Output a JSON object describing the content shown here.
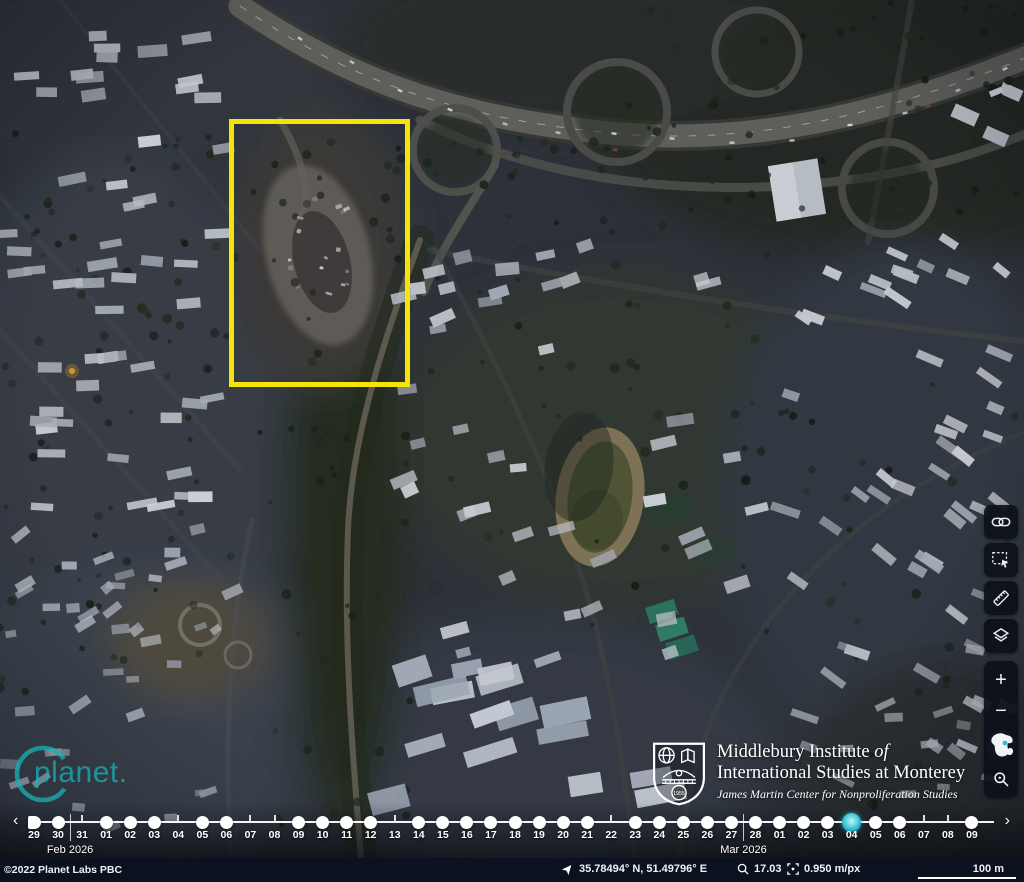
{
  "colors": {
    "annotation": "#f5e409",
    "selected_date": "#14aac2",
    "planet_teal": "#19b2b8",
    "timeline_dot": "#ffffff"
  },
  "toolbar": {
    "buttons": [
      {
        "name": "share-link",
        "icon": "link-icon"
      },
      {
        "name": "select-area",
        "icon": "selection-icon"
      },
      {
        "name": "measure",
        "icon": "ruler-icon"
      },
      {
        "name": "layers",
        "icon": "layers-icon"
      }
    ]
  },
  "zoom_controls": {
    "zoom_in": "+",
    "zoom_out": "−",
    "globe": "globe-icon",
    "search": "magnifier-icon"
  },
  "timeline": {
    "prev": "‹",
    "next": "›",
    "months": [
      {
        "label": "Feb 2026",
        "after_index": 1
      },
      {
        "label": "Mar 2026",
        "after_index": 29
      }
    ],
    "dates": [
      {
        "day": "29",
        "dot": true
      },
      {
        "day": "30",
        "dot": true
      },
      {
        "day": "31",
        "dot": false
      },
      {
        "day": "01",
        "dot": true
      },
      {
        "day": "02",
        "dot": true
      },
      {
        "day": "03",
        "dot": true
      },
      {
        "day": "04",
        "dot": false
      },
      {
        "day": "05",
        "dot": true
      },
      {
        "day": "06",
        "dot": true
      },
      {
        "day": "07",
        "dot": false
      },
      {
        "day": "08",
        "dot": false
      },
      {
        "day": "09",
        "dot": true
      },
      {
        "day": "10",
        "dot": true
      },
      {
        "day": "11",
        "dot": true
      },
      {
        "day": "12",
        "dot": true
      },
      {
        "day": "13",
        "dot": false
      },
      {
        "day": "14",
        "dot": true
      },
      {
        "day": "15",
        "dot": true
      },
      {
        "day": "16",
        "dot": true
      },
      {
        "day": "17",
        "dot": true
      },
      {
        "day": "18",
        "dot": true
      },
      {
        "day": "19",
        "dot": true
      },
      {
        "day": "20",
        "dot": true
      },
      {
        "day": "21",
        "dot": true
      },
      {
        "day": "22",
        "dot": false
      },
      {
        "day": "23",
        "dot": true
      },
      {
        "day": "24",
        "dot": true
      },
      {
        "day": "25",
        "dot": true
      },
      {
        "day": "26",
        "dot": true
      },
      {
        "day": "27",
        "dot": true
      },
      {
        "day": "28",
        "dot": true
      },
      {
        "day": "01",
        "dot": true
      },
      {
        "day": "02",
        "dot": true
      },
      {
        "day": "03",
        "dot": true
      },
      {
        "day": "04",
        "dot": true,
        "selected": true
      },
      {
        "day": "05",
        "dot": true
      },
      {
        "day": "06",
        "dot": true
      },
      {
        "day": "07",
        "dot": false
      },
      {
        "day": "08",
        "dot": false
      },
      {
        "day": "09",
        "dot": true
      }
    ]
  },
  "statusbar": {
    "copyright": "©2022 Planet Labs PBC",
    "location_icon": "location-arrow-icon",
    "coordinates": "35.78494° N, 51.49796° E",
    "zoom_icon": "magnifier-icon",
    "zoom_level": "17.03",
    "resolution_icon": "resolution-icon",
    "resolution": "0.950 m/px",
    "scale_label": "100 m"
  },
  "watermarks": {
    "planet": "planet.",
    "institute": {
      "line1_main": "Middlebury Institute ",
      "line1_italic": "of",
      "line2": "International Studies at Monterey",
      "line3": "James Martin Center for Nonproliferation Studies",
      "seal_year": "1955"
    }
  }
}
